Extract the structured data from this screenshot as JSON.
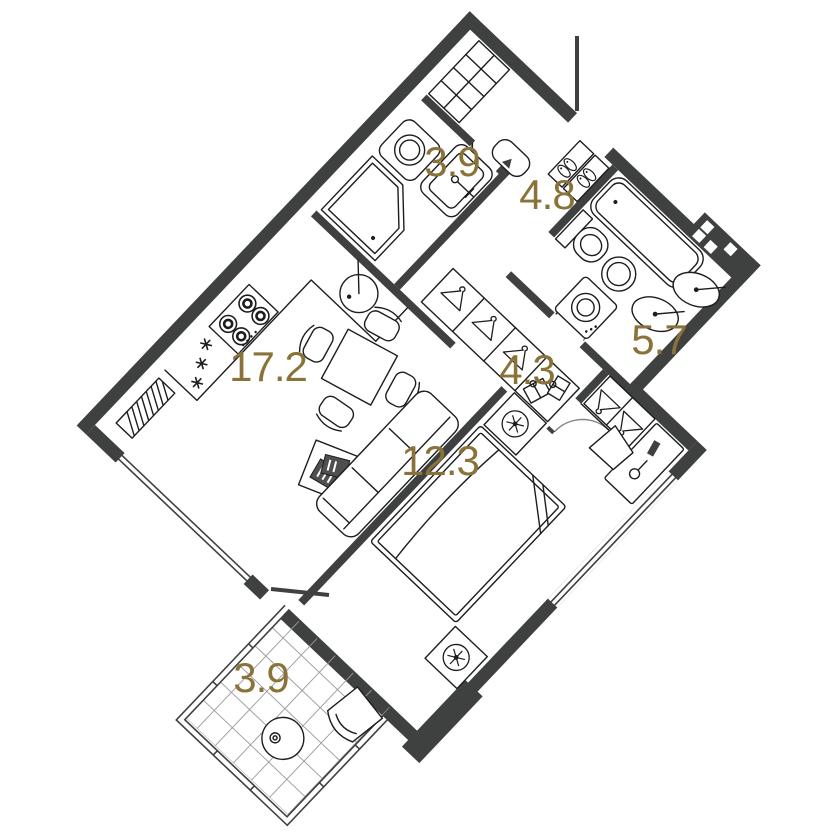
{
  "plan": {
    "type": "floor-plan",
    "rooms": [
      {
        "name": "kitchen-living",
        "area": "17.2"
      },
      {
        "name": "bathroom-top",
        "area": "3.9"
      },
      {
        "name": "hallway",
        "area": "4.8"
      },
      {
        "name": "bathroom-main",
        "area": "5.7"
      },
      {
        "name": "corridor",
        "area": "4.3"
      },
      {
        "name": "bedroom",
        "area": "12.3"
      },
      {
        "name": "balcony",
        "area": "3.9"
      }
    ],
    "palette": {
      "wall": "#3f4040",
      "line": "#1d1d1d",
      "label": "#8a7339",
      "tile": "#9a9a9a",
      "background": "#ffffff"
    }
  }
}
